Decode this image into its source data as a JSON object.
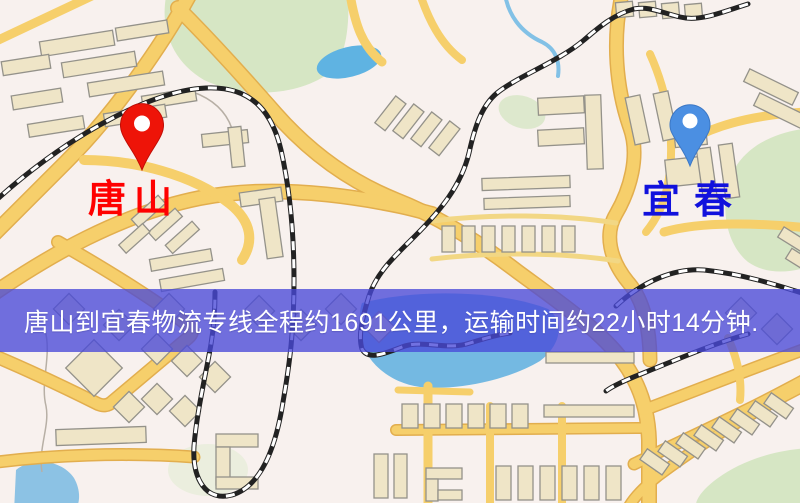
{
  "route_banner": {
    "text": "唐山到宜春物流专线全程约1691公里，运输时间约22小时14分钟.",
    "background_color": "#4949d8",
    "text_color": "#ffffff"
  },
  "origin_marker": {
    "label": "唐山",
    "pin_icon": "map-pin",
    "pin_color": "#ee1408",
    "label_color": "#ff0000"
  },
  "destination_marker": {
    "label": "宜春",
    "pin_icon": "map-pin",
    "pin_color": "#4b8fe2",
    "label_color": "#1111dd"
  },
  "route": {
    "origin": "唐山",
    "destination": "宜春",
    "distance_text": "约1691公里",
    "duration_text": "约22小时14分钟"
  },
  "map_palette": {
    "background": "#f8f1ee",
    "road": "#f6cf6b",
    "road_casing": "#e2ae4e",
    "building": "#efe5c7",
    "building_stroke": "#94928a",
    "park": "#d6e6c4",
    "water": "#64b5e3",
    "railway_dark": "#222222",
    "railway_light": "#ffffff"
  }
}
